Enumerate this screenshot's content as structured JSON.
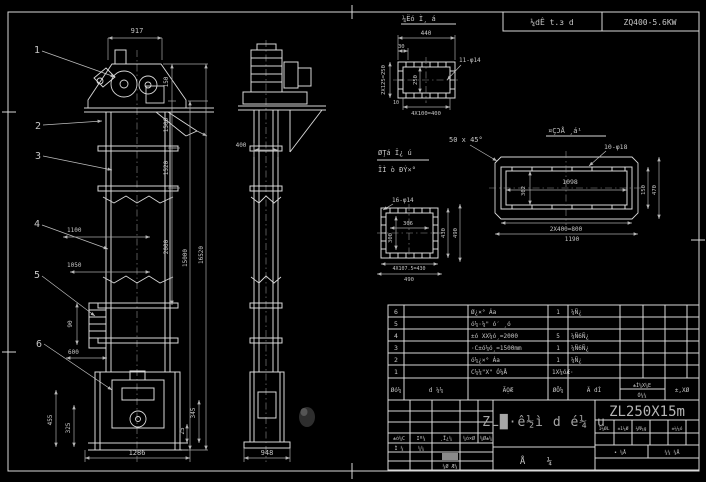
{
  "header": {
    "band_note": "¼dÊ t.з d",
    "motor_spec": "ZQ400-5.6KW"
  },
  "balloons": [
    "1",
    "2",
    "3",
    "4",
    "5",
    "6"
  ],
  "front": {
    "dim_917": "917",
    "dim_150": "150",
    "dim_1500": "1500",
    "dim_1520": "1520",
    "dim_2000": "2000",
    "dim_15000": "15000",
    "dim_total": "16520",
    "dim_1100": "1100",
    "dim_1050": "1050",
    "dim_90": "90",
    "dim_600": "600",
    "dim_455": "455",
    "dim_325": "325",
    "dim_345": "345",
    "dim_25": "25",
    "dim_base": "1286"
  },
  "side": {
    "dim_400": "400",
    "dim_base": "948"
  },
  "detail_a": {
    "label": "¼Ëó Ì¸ á",
    "dim_440": "440",
    "dim_30": "30",
    "holes": "11-φ14",
    "dim_left": "2X125=250",
    "dim_inner": "250",
    "dim_10": "10",
    "dim_bottom": "4X100=400"
  },
  "detail_b": {
    "label1": "ØŢá Ï¿ ú",
    "label2": "ÏÌ ò ÐÝ×°",
    "holes": "16-φ14",
    "dim_inner_w": "306",
    "dim_inner_h": "300",
    "dim_right1": "430",
    "dim_right2": "490",
    "dim_bottom1": "4X107.5=430",
    "dim_bottom2": "490"
  },
  "detail_c": {
    "label": "¤ÇϽÅ ¸á¹",
    "chamfer": "50 x 45°",
    "holes": "10-φ18",
    "dim_inner": "1098",
    "dim_inner_h": "302",
    "dim_right1": "150",
    "dim_right2": "470",
    "dim_bottom1": "2X400=800",
    "dim_bottom2": "1190"
  },
  "bom": {
    "headers": {
      "no": "Øó¼",
      "code": "d ¼¼",
      "name": "ÃỌ̈Æ",
      "qty": "ØÔ¼",
      "mat": "Ä dÌ",
      "wt_top": "±Ì¼X¼E",
      "wt_bot": "Ó¼¼",
      "rem": "±,XØ"
    },
    "rows": [
      {
        "no": "6",
        "name": "Ø¿×° Áa",
        "qty": "1",
        "mat": "¼Ñ¿"
      },
      {
        "no": "5",
        "name": "ó¼·¼\" ó′ ¸ó",
        "qty": "",
        "mat": ""
      },
      {
        "no": "4",
        "name": "±ó XX¼ó¸=2000",
        "qty": "5",
        "mat": "¼Ñ6Ñ¿"
      },
      {
        "no": "3",
        "name": "·C±ó¼ó¸=1500mm",
        "qty": "1",
        "mat": "¼Ñ6Ñ¿"
      },
      {
        "no": "2",
        "name": "ó¼¿×° Áa",
        "qty": "1",
        "mat": "¼Ñ¿"
      },
      {
        "no": "1",
        "name": "C¼¼\"X\" Ó¼Å",
        "qty": "1X¼óÆ·",
        "mat": ""
      }
    ]
  },
  "title_block": {
    "main_title": "ZL█·ê½ì d é¼ u",
    "drawing_no": "ZL250X15m",
    "sheet_label": "Å ¼",
    "rev_row": [
      "±ó¼C",
      "Iº¼",
      "¸Ï¿¼",
      "¼ó×Ø",
      "¼Ø±¼"
    ],
    "design_label": "Ì ¼",
    "sign_label": "¼¼",
    "approve_label": "¼Ø Æ¼",
    "right_headers": [
      "1¼ØL",
      "±1¼Ø",
      "¼Ñ¼g",
      "±¼¼ó"
    ],
    "sheet_row": [
      "• ¼Å",
      "¼¼ ¼Å"
    ]
  }
}
